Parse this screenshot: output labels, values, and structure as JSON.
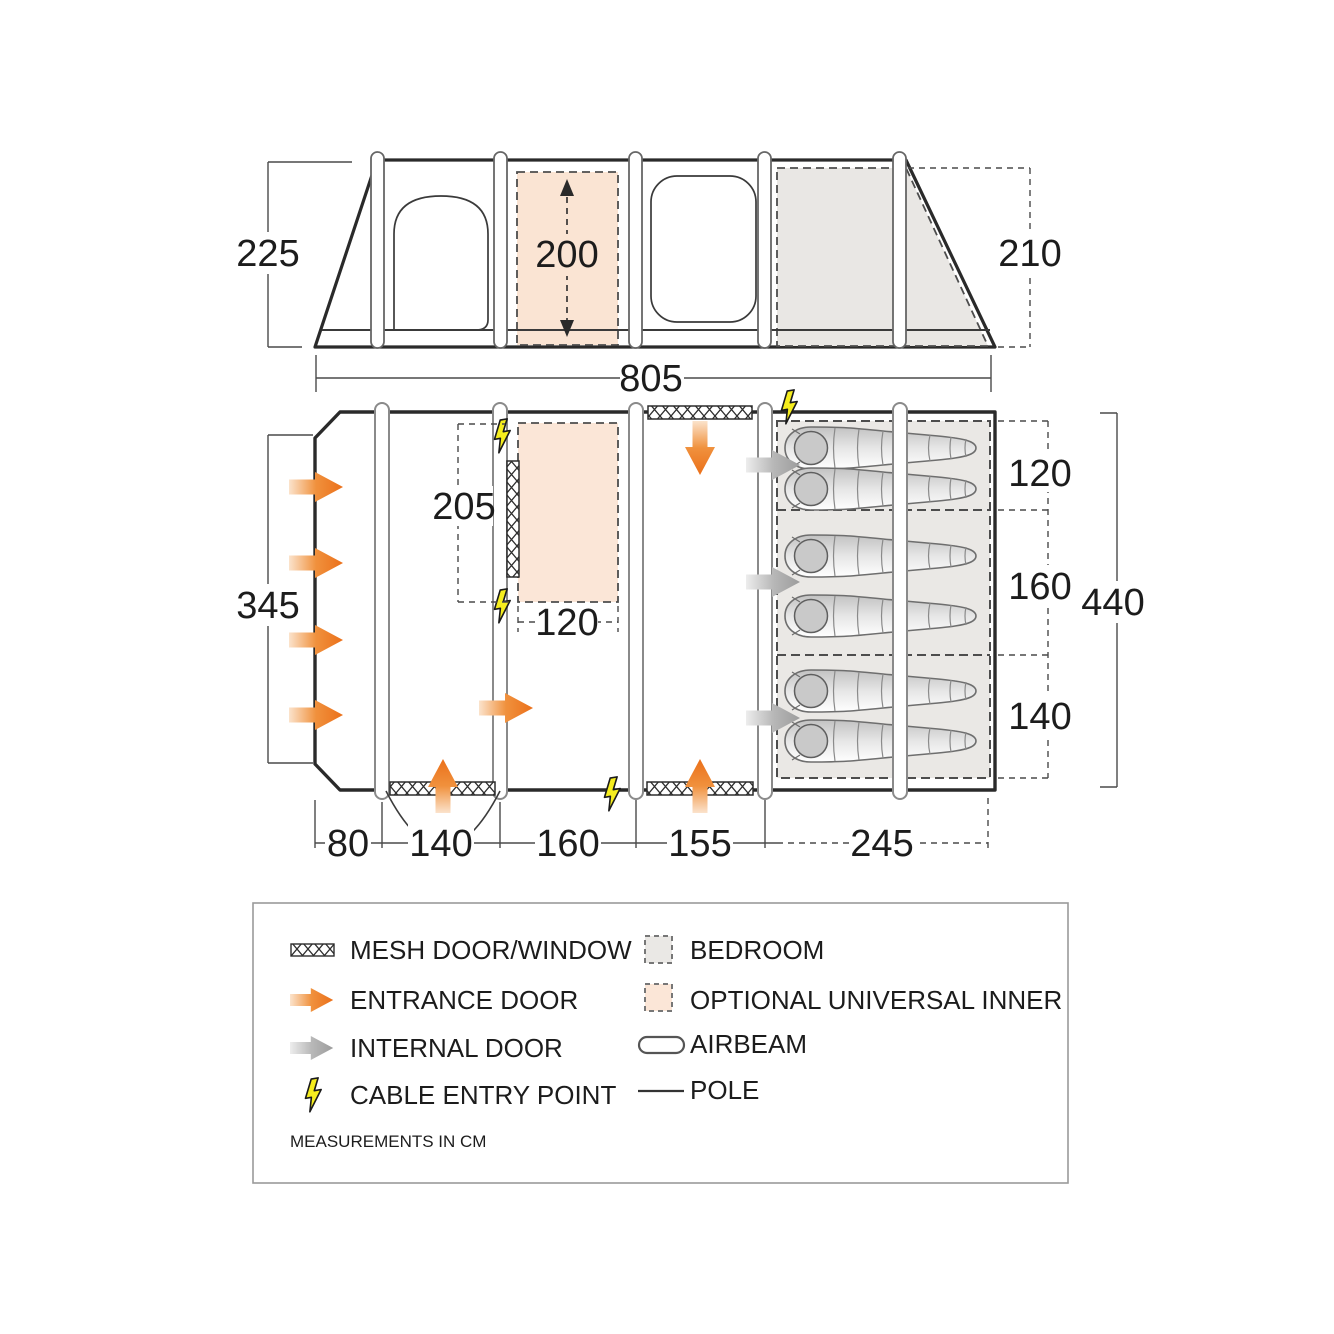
{
  "side_view": {
    "height_left": "225",
    "inner_height": "200",
    "height_right": "210"
  },
  "floor_plan": {
    "width_total": "805",
    "depth_left": "345",
    "inner_depth": "205",
    "inner_width": "120",
    "bedroom_depths": [
      "120",
      "160",
      "140"
    ],
    "depth_total": "440",
    "bottom_widths": [
      "80",
      "140",
      "160",
      "155",
      "245"
    ]
  },
  "legend": {
    "items": [
      {
        "label": "MESH DOOR/WINDOW"
      },
      {
        "label": "ENTRANCE DOOR"
      },
      {
        "label": "INTERNAL DOOR"
      },
      {
        "label": "CABLE ENTRY POINT"
      },
      {
        "label": "BEDROOM"
      },
      {
        "label": "OPTIONAL UNIVERSAL INNER"
      },
      {
        "label": "AIRBEAM"
      },
      {
        "label": "POLE"
      }
    ],
    "note": "MEASUREMENTS IN CM"
  },
  "colors": {
    "entrance_orange": "#eb701a",
    "internal_grey": "#9c9c9c",
    "cable_yellow": "#f5ed1e",
    "bedroom_fill": "#eae8e5",
    "inner_fill": "#fbe6d7"
  }
}
